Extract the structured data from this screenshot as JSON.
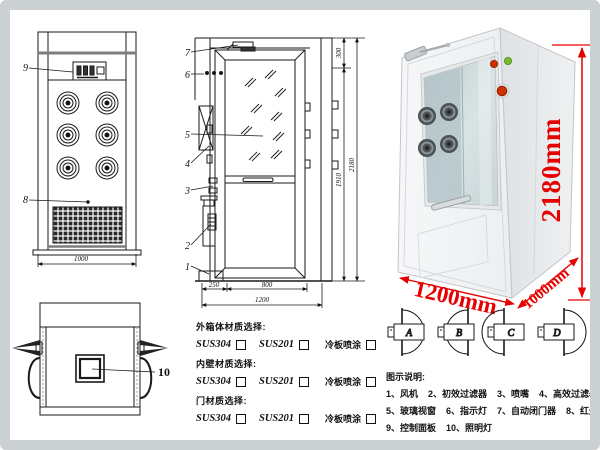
{
  "front_view": {
    "label_9": "9",
    "label_8": "8",
    "width_dim": "1000"
  },
  "section_view": {
    "part_labels": [
      "7",
      "6",
      "5",
      "4",
      "3",
      "2",
      "1"
    ],
    "dim_top": "300",
    "dim_door": "1910",
    "dim_total": "2180",
    "dim_a": "250",
    "dim_b": "800",
    "dim_c": "1200"
  },
  "photo": {
    "height_label": "2180mm",
    "width_label": "1200mm",
    "depth_label": "1000mm"
  },
  "plan_view": {
    "label_10": "10"
  },
  "materials": {
    "groups": [
      {
        "title": "外箱体材质选择:",
        "options": [
          "SUS304",
          "SUS201",
          "冷板喷涂"
        ]
      },
      {
        "title": "内壁材质选择:",
        "options": [
          "SUS304",
          "SUS201",
          "冷板喷涂"
        ]
      },
      {
        "title": "门材质选择:",
        "options": [
          "SUS304",
          "SUS201",
          "冷板喷涂"
        ]
      }
    ]
  },
  "door_configs": {
    "labels": [
      "A",
      "B",
      "C",
      "D"
    ]
  },
  "legend": {
    "title": "图示说明:",
    "rows": [
      [
        "1、风机",
        "2、初效过滤器",
        "3、喷嘴",
        "4、高效过滤器"
      ],
      [
        "5、玻璃视窗",
        "6、指示灯",
        "7、自动闭门器",
        "8、红外线感应器"
      ],
      [
        "9、控制面板",
        "10、照明灯"
      ]
    ]
  },
  "colors": {
    "accent_red": "#e60000",
    "line": "#1a1a1a"
  }
}
